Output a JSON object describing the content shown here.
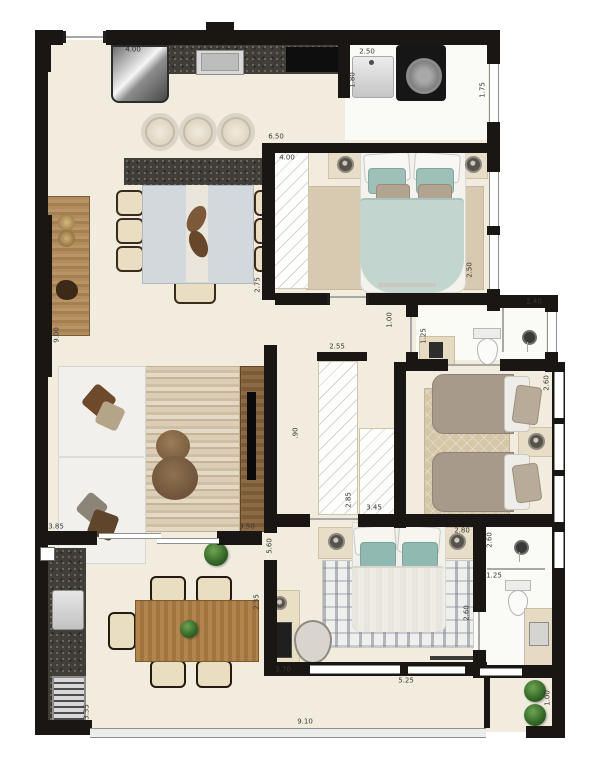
{
  "dims": {
    "kitchen_depth": "4.00",
    "laundry_width": "2.50",
    "kitchen_wall": "1.80",
    "laundry_window": "1.75",
    "suite1_width": "6.50",
    "suite1_closet": "4.00",
    "suite1_left": "2.75",
    "suite1_right": "2.50",
    "bath1_width": "2.40",
    "hall_width": "1.00",
    "bath1_left": "1.25",
    "hall_length": "2.55",
    "hall_narrow": ".90",
    "wardrobe1": "2.85",
    "wardrobe2": "3.45",
    "bedroom2_side": "2.60",
    "living_side": "9.00",
    "living_left": "3.85",
    "living_right": "3.50",
    "bedroom3_side": "5.60",
    "bedroom3_top": "2.80",
    "bedroom3_right": "2.60",
    "bath2_width": "1.25",
    "bath2_shower": "2.60",
    "terrace_side": "2.35",
    "desk_length": "3.70",
    "bedroom3_width": "5.25",
    "terrace_left": "3.35",
    "balcony_width": "9.10",
    "planter_height": "1.00"
  }
}
